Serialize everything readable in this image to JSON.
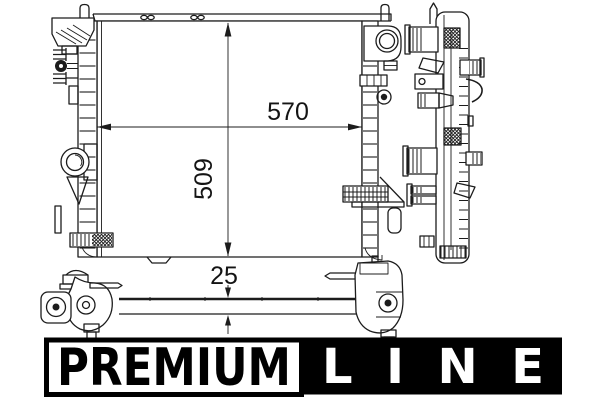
{
  "page": {
    "background": "#ffffff",
    "line_color": "#1c1c1c"
  },
  "diagram": {
    "dimensions": {
      "width": "570",
      "height": "509",
      "depth": "25"
    }
  },
  "logo": {
    "premium_label": "PREMIUM",
    "line_label": "LINE",
    "premium_bg": "#ffffff",
    "premium_fg": "#000000",
    "line_bg": "#000000",
    "line_fg": "#ffffff"
  }
}
